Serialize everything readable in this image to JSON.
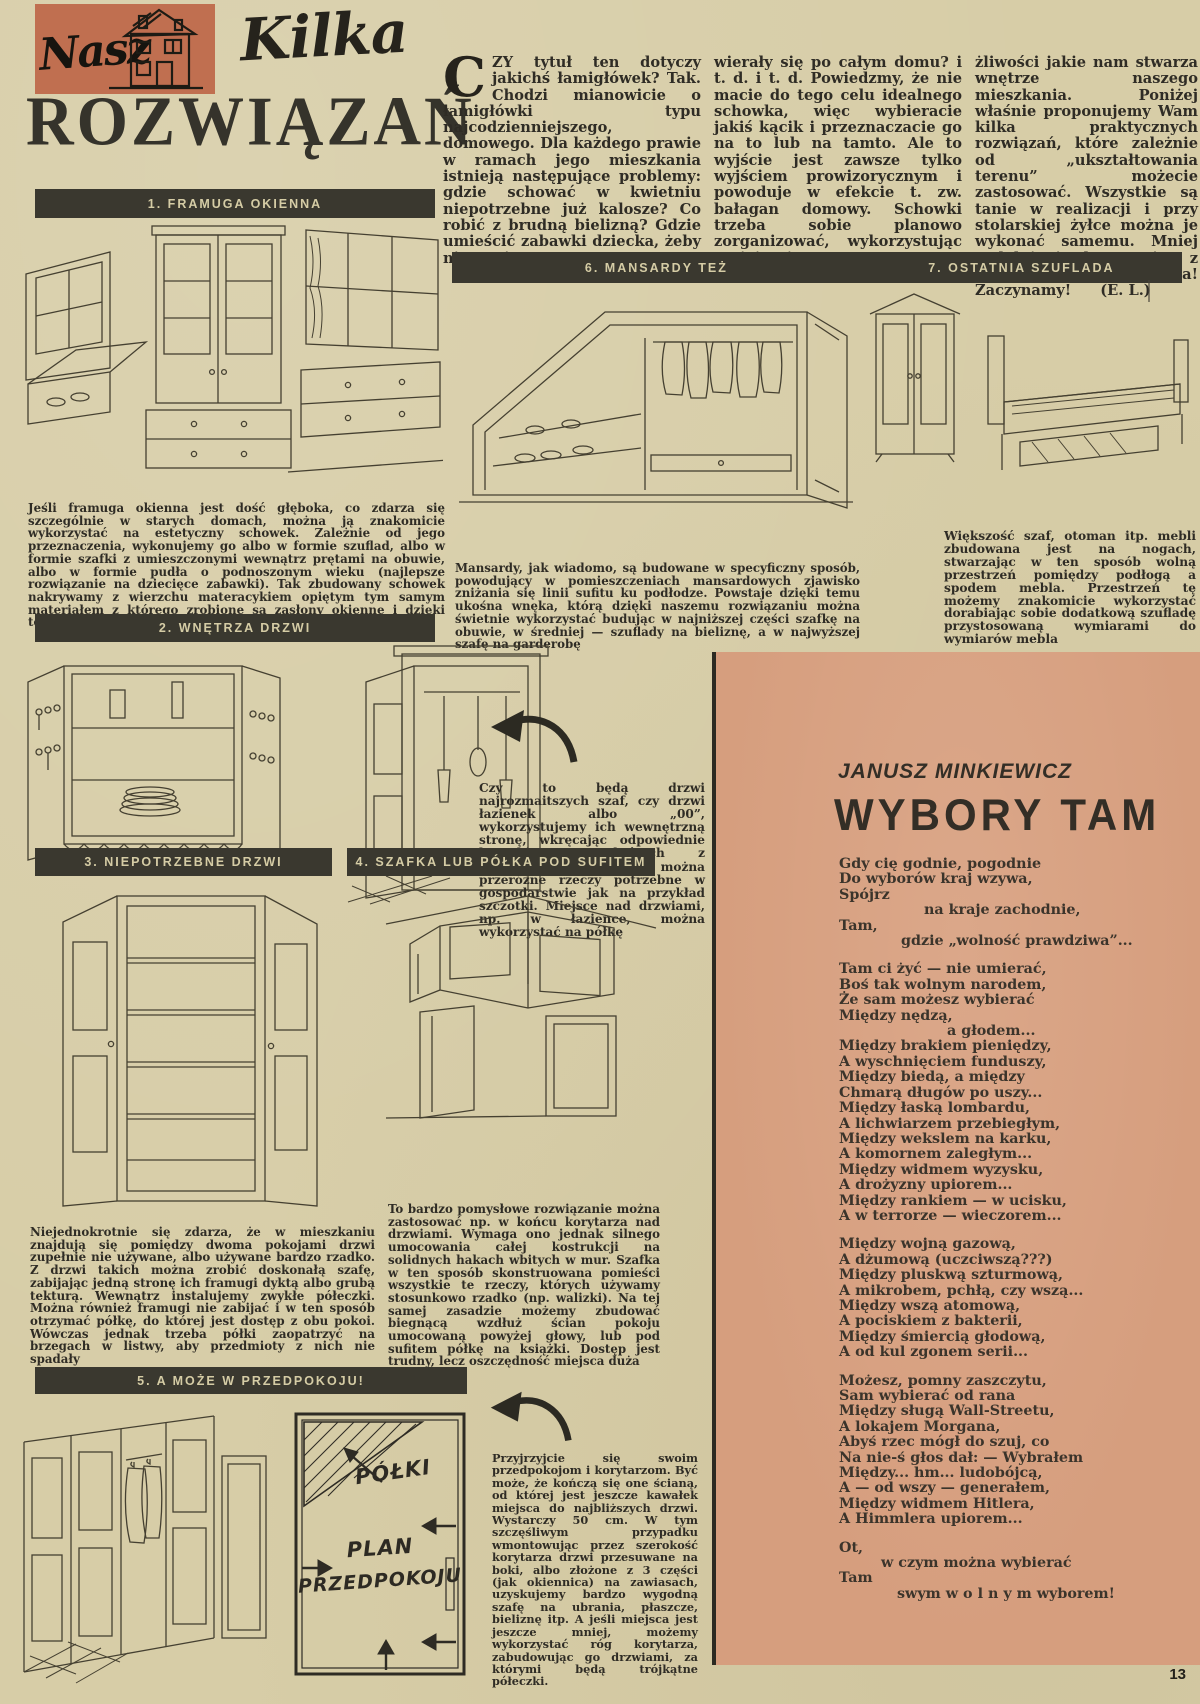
{
  "page_number": "13",
  "masthead": {
    "logo_text": "Nasz",
    "title_script": "Kilka",
    "title_main": "ROZWIĄZAŃ"
  },
  "intro": {
    "drop_cap": "C",
    "col1": "ZY tytuł ten dotyczy jakichś łamigłówek? Tak. Chodzi mianowicie o łamigłówki typu najcodzienniejszego, domowego. Dla każdego prawie w ramach jego mieszkania istnieją następujące problemy: gdzie schować w kwietniu niepotrzebne już kalosze? Co robić z brudną bielizną? Gdzie umieścić zabawki dziecka, żeby nie ponie-",
    "col2": "wierały się po całym domu? i t. d. i t. d. Powiedzmy, że nie macie do tego celu idealnego schowka, więc wybieracie jakiś kącik i przeznaczacie go na to lub na tamto. Ale to wyjście jest zawsze tylko wyjściem prowizorycznym i powoduje w efekcie t. zw. bałagan domowy. Schowki trzeba sobie planowo zorganizować, wykorzystując umiejętnie mo-",
    "col3": "żliwości jakie nam stwarza wnętrze naszego mieszkania. Poniżej właśnie proponujemy Wam kilka praktycznych rozwiązań, które zależnie od „ukształtowania terenu” możecie zastosować. Wszystkie są tanie w realizacji i przy stolarskiej żyłce można je wykonać samemu. Mniej uzdolnieni korzystają z pomocy stolarza. Uwaga! Zaczynamy!",
    "byline": "(E. L.)"
  },
  "sections": {
    "s1": {
      "header": "1. FRAMUGA OKIENNA",
      "body": "Jeśli framuga okienna jest dość głęboka, co zdarza się szczególnie w starych domach, można ją znakomicie wykorzystać na estetyczny schowek. Zależnie od jego przeznaczenia, wykonujemy go albo w formie szuflad, albo w formie szafki z umieszczonymi wewnątrz prętami na obuwie, albo w formie pudła o podnoszonym wieku (najlepsze rozwiązanie na dziecięce zabawki). Tak zbudowany schowek nakrywamy z wierzchu materacykiem opiętym tym samym materiałem z którego zrobione są zasłony okienne i dzięki temu uzyskujemy przyjemną ławeczkę"
    },
    "s2": {
      "header": "2. WNĘTRZA DRZWI",
      "body": "Czy to będą drzwi najrozmaitszych szaf, czy drzwi łazienek albo „00”, wykorzystujemy ich wewnętrzną stronę, wkręcając odpowiednie haczyki na których z powodzeniem zawiesić można przeróżne rzeczy potrzebne w gospodarstwie jak na przykład szczotki. Miejsce nad drzwiami, np. w łazience, można wykorzystać na półkę"
    },
    "s3": {
      "header": "3. NIEPOTRZEBNE DRZWI",
      "body": "Niejednokrotnie się zdarza, że w mieszkaniu znajdują się pomiędzy dwoma pokojami drzwi zupełnie nie używane, albo używane bardzo rzadko. Z drzwi takich można zrobić doskonałą szafę, zabijając jedną stronę ich framugi dyktą albo grubą tekturą. Wewnątrz instalujemy zwykłe półeczki. Można również framugi nie zabijać i w ten sposób otrzymać półkę, do której jest dostęp z obu pokoi. Wówczas jednak trzeba półki zaopatrzyć na brzegach w listwy, aby przedmioty z nich nie spadały"
    },
    "s4": {
      "header": "4. SZAFKA LUB PÓŁKA POD SUFITEM",
      "body": "To bardzo pomysłowe rozwiązanie można zastosować np. w końcu korytarza nad drzwiami. Wymaga ono jednak silnego umocowania całej kostrukcji na solidnych hakach wbitych w mur. Szafka w ten sposób skonstruowana pomieści wszystkie te rzeczy, których używamy stosunkowo rzadko (np. walizki). Na tej samej zasadzie możemy zbudować biegnącą wzdłuż ścian pokoju umocowaną powyżej głowy, lub pod sufitem półkę na książki. Dostęp jest trudny, lecz oszczędność miejsca duża"
    },
    "s5": {
      "header": "5. A MOŻE W PRZEDPOKOJU!",
      "body": "Przyjrzyjcie się swoim przedpokojom i korytarzom. Być może, że kończą się one ścianą, od której jest jeszcze kawałek miejsca do najbliższych drzwi. Wystarczy 50 cm. W tym szczęśliwym przypadku wmontowując przez szerokość korytarza drzwi przesuwane na boki, albo złożone z 3 części (jak okiennica) na zawiasach, uzyskujemy bardzo wygodną szafę na ubrania, płaszcze, bieliznę itp. A jeśli miejsca jest jeszcze mniej, możemy wykorzystać róg korytarza, zabudowując go drzwiami, za którymi będą trójkątne półeczki."
    },
    "s6": {
      "header": "6. MANSARDY TEŻ",
      "body": "Mansardy, jak wiadomo, są budowane w specyficzny sposób, powodujący w pomieszczeniach mansardowych zjawisko zniżania się linii sufitu ku podłodze. Powstaje dzięki temu ukośna wnęka, którą dzięki naszemu rozwiązaniu można świetnie wykorzystać budując w najniższej części szafkę na obuwie, w średniej — szuflady na bieliznę, a w najwyższej szafę na garderobę"
    },
    "s7": {
      "header": "7. OSTATNIA SZUFLADA",
      "body": "Większość szaf, otoman itp. mebli zbudowana jest na nogach, stwarzając w ten sposób wolną przestrzeń pomiędzy podłogą a spodem mebla. Przestrzeń tę możemy znakomicie wykorzystać dorabiając sobie dodatkową szufladę przystosowaną wymiarami do wymiarów mebla"
    }
  },
  "plan_diagram": {
    "label_shelves": "PÓŁKI",
    "label_line1": "PLAN",
    "label_line2": "PRZEDPOKOJU"
  },
  "poem": {
    "author": "JANUSZ MINKIEWICZ",
    "title": "WYBORY TAM",
    "stanzas": [
      [
        {
          "t": "Gdy cię godnie, pogodnie",
          "i": 0
        },
        {
          "t": "Do wyborów kraj wzywa,",
          "i": 0
        },
        {
          "t": "Spójrz",
          "i": 0
        },
        {
          "t": "na kraje zachodnie,",
          "i": 85
        },
        {
          "t": "Tam,",
          "i": 0
        },
        {
          "t": "gdzie „wolność prawdziwa”...",
          "i": 62
        }
      ],
      [
        {
          "t": "Tam ci żyć — nie umierać,",
          "i": 0
        },
        {
          "t": "Boś tak wolnym narodem,",
          "i": 0
        },
        {
          "t": "Że sam możesz wybierać",
          "i": 0
        },
        {
          "t": "Między nędzą,",
          "i": 0
        },
        {
          "t": "a głodem...",
          "i": 108
        },
        {
          "t": "Między brakiem pieniędzy,",
          "i": 0
        },
        {
          "t": "A wyschnięciem funduszy,",
          "i": 0
        },
        {
          "t": "Między biedą, a między",
          "i": 0
        },
        {
          "t": "Chmarą długów po uszy...",
          "i": 0
        },
        {
          "t": "Między łaską lombardu,",
          "i": 0
        },
        {
          "t": "A lichwiarzem przebiegłym,",
          "i": 0
        },
        {
          "t": "Między wekslem na karku,",
          "i": 0
        },
        {
          "t": "A komornem zaległym...",
          "i": 0
        },
        {
          "t": "Między widmem wyzysku,",
          "i": 0
        },
        {
          "t": "A drożyzny upiorem...",
          "i": 0
        },
        {
          "t": "Między rankiem — w ucisku,",
          "i": 0
        },
        {
          "t": "A w terrorze — wieczorem...",
          "i": 0
        }
      ],
      [
        {
          "t": "Między wojną gazową,",
          "i": 0
        },
        {
          "t": "A dżumową (uczciwszą???)",
          "i": 0
        },
        {
          "t": "Między pluskwą szturmową,",
          "i": 0
        },
        {
          "t": "A mikrobem, pchłą, czy wszą...",
          "i": 0
        },
        {
          "t": "Między wszą atomową,",
          "i": 0
        },
        {
          "t": "A pociskiem z bakterii,",
          "i": 0
        },
        {
          "t": "Między śmiercią głodową,",
          "i": 0
        },
        {
          "t": "A od kul zgonem serii...",
          "i": 0
        }
      ],
      [
        {
          "t": "Możesz, pomny zaszczytu,",
          "i": 0
        },
        {
          "t": "Sam wybierać od rana",
          "i": 0
        },
        {
          "t": "Między sługą Wall-Streetu,",
          "i": 0
        },
        {
          "t": "A lokajem Morgana,",
          "i": 0
        },
        {
          "t": "Abyś rzec mógł do szuj, co",
          "i": 0
        },
        {
          "t": "Na nie-ś głos dał: — Wybrałem",
          "i": 0
        },
        {
          "t": "Między... hm... ludobójcą,",
          "i": 0
        },
        {
          "t": "A — od wszy — generałem,",
          "i": 0
        },
        {
          "t": "Między widmem Hitlera,",
          "i": 0
        },
        {
          "t": "A Himmlera upiorem...",
          "i": 0
        }
      ],
      [
        {
          "t": "Ot,",
          "i": 0
        },
        {
          "t": "w czym można wybierać",
          "i": 42
        },
        {
          "t": "Tam",
          "i": 0
        },
        {
          "t": "swym  w o l n y m  wyborem!",
          "i": 58
        }
      ]
    ]
  },
  "colors": {
    "paper": "#d7cda7",
    "bar": "#3a382f",
    "logo_bg": "#c06f50",
    "poem_bg": "#d69e7e",
    "ink": "#2f2c25"
  }
}
